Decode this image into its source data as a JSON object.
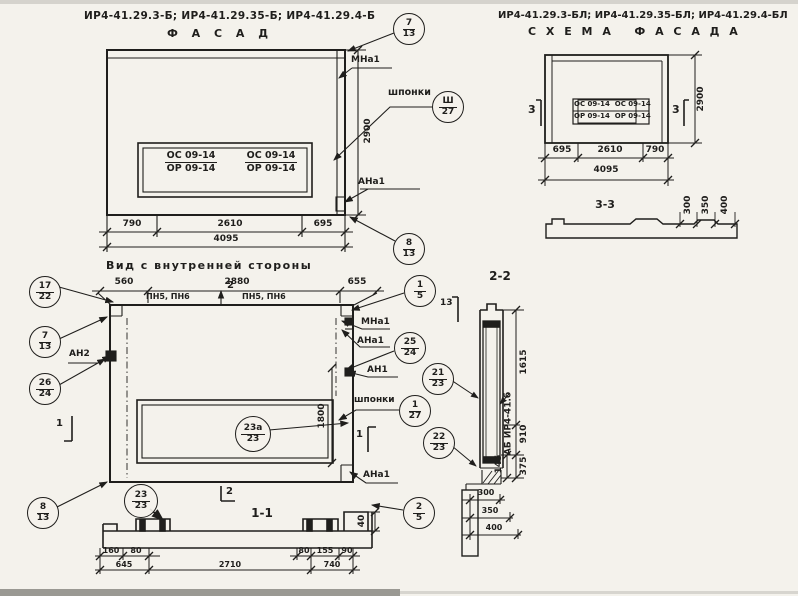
{
  "colors": {
    "paper": "#f4f2ec",
    "ink": "#1f1e1c"
  },
  "facade": {
    "title": "ИР4-41.29.3-Б; ИР4-41.29.35-Б; ИР4-41.29.4-Б",
    "subtitle": "Ф А С А Д",
    "window_marks": {
      "c1_top": "ОС 09-14",
      "c1_bot": "ОР 09-14",
      "c2_top": "ОС 09-14",
      "c2_bot": "ОР 09-14"
    },
    "labels": {
      "mna1": "МНа1",
      "shponki": "шпонки",
      "ana1": "АНа1"
    },
    "callouts": {
      "c713": {
        "top": "7",
        "bot": "13"
      },
      "csh": {
        "top": "Ш",
        "bot": "27"
      },
      "c813": {
        "top": "8",
        "bot": "13"
      }
    },
    "dims": {
      "d1": "790",
      "d2": "2610",
      "d3": "695",
      "total": "4095",
      "height": "2900"
    }
  },
  "schema": {
    "title": "ИР4-41.29.3-БЛ; ИР4-41.29.35-БЛ; ИР4-41.29.4-БЛ",
    "subtitle": "С Х Е М А   Ф А С А Д А",
    "window_marks": {
      "r1": "ОС 09-14  ОС 09-14",
      "r2": "ОР 09-14  ОР 09-14"
    },
    "section_mark": "3",
    "dims": {
      "d1": "695",
      "d2": "2610",
      "d3": "790",
      "total": "4095",
      "height": "2900"
    },
    "sec33": {
      "title": "3-3",
      "w1": "300",
      "w2": "350",
      "w3": "400"
    }
  },
  "inner": {
    "title": "Вид с внутренней стороны",
    "dims": {
      "d1": "560",
      "d2": "2880",
      "d3": "655",
      "window": "1800",
      "lip": "40"
    },
    "pn_left": "ПН5, ПН6",
    "pn_right": "ПН5, ПН6",
    "labels": {
      "an2": "АН2",
      "mna1": "МНа1",
      "ana1": "АНа1",
      "an1": "АН1",
      "shponki": "шпонки",
      "ana1b": "АНа1"
    },
    "callouts": {
      "c1722": {
        "top": "17",
        "bot": "22"
      },
      "c713": {
        "top": "7",
        "bot": "13"
      },
      "c2624": {
        "top": "26",
        "bot": "24"
      },
      "c15": {
        "top": "1",
        "bot": "5"
      },
      "c2524": {
        "top": "25",
        "bot": "24"
      },
      "c127": {
        "top": "1",
        "bot": "27"
      },
      "c23a": {
        "top": "23а",
        "bot": "23"
      },
      "c813": {
        "top": "8",
        "bot": "13"
      },
      "c2323": {
        "top": "23",
        "bot": "23"
      },
      "c25": {
        "top": "2",
        "bot": "5"
      }
    },
    "marks": {
      "s1": "1",
      "s2": "2"
    }
  },
  "sec11": {
    "title": "1-1",
    "dims": {
      "a1": "160",
      "a2": "80",
      "a3": "80",
      "a4": "155",
      "a5": "90",
      "b1": "645",
      "b2": "2710",
      "b3": "740"
    }
  },
  "sec22": {
    "title": "2-2",
    "mark": "13",
    "part_label": "АБ ИР4-41.б",
    "callouts": {
      "c2123": {
        "top": "21",
        "bot": "23"
      },
      "c2223": {
        "top": "22",
        "bot": "23"
      }
    },
    "dims": {
      "h1": "1615",
      "h2": "910",
      "h3": "145",
      "h4": "375",
      "w1": "300",
      "w2": "350",
      "w3": "400"
    }
  }
}
